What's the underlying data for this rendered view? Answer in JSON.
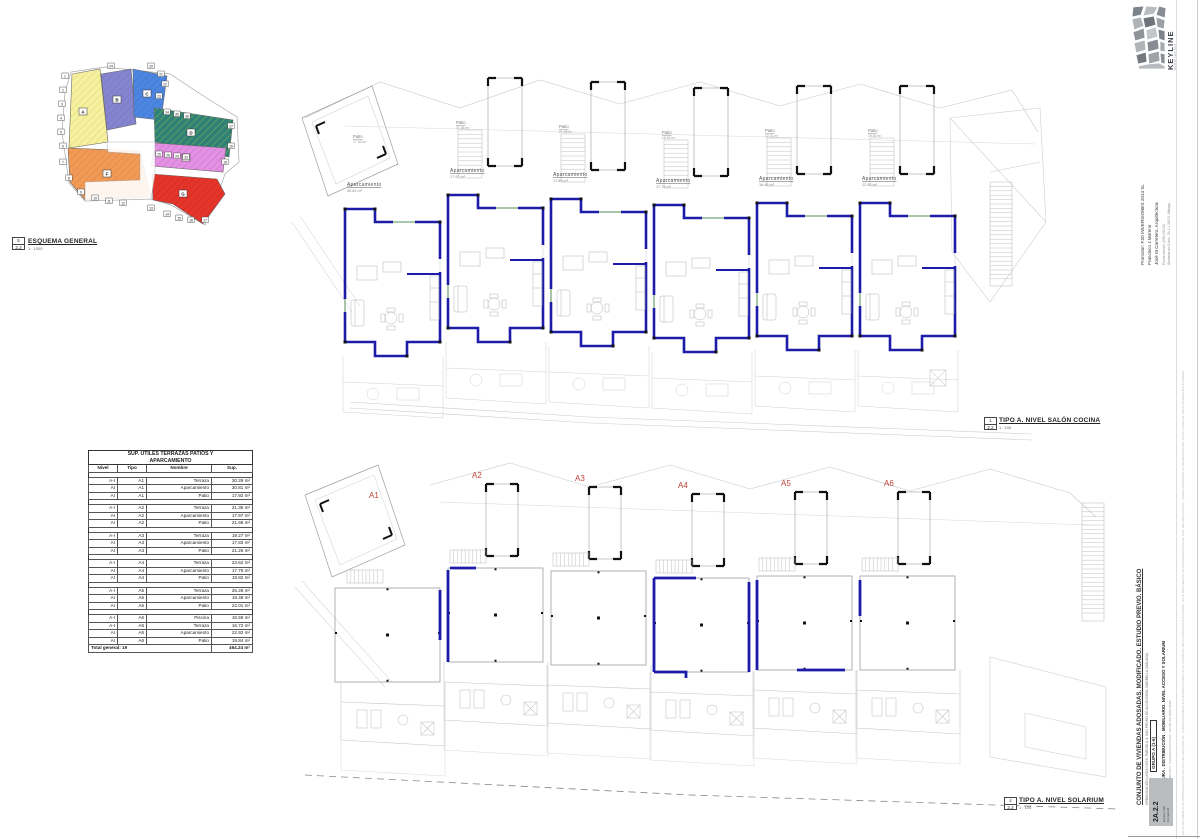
{
  "accent": {
    "wall_blue": "#1c1ca8",
    "unit_red": "#c04038"
  },
  "esquema": {
    "tag_num": "5",
    "tag_sheet": "2.2",
    "title": "ESQUEMA GENERAL",
    "scale": "1 : 1000",
    "zones": [
      {
        "id": "yellow",
        "label": "A",
        "color": "#f5f1a0",
        "hatch": "#d8ca55",
        "points": "17,12 45,7 53,80 14,86",
        "lx": 28,
        "ly": 50
      },
      {
        "id": "purple",
        "label": "B",
        "color": "#8585cf",
        "hatch": "#6a6ab8",
        "points": "46,12 76,7 81,62 52,68",
        "lx": 62,
        "ly": 38
      },
      {
        "id": "blue",
        "label": "C",
        "color": "#4d86e0",
        "hatch": "#3568c4",
        "points": "78,7 112,14 106,58 79,55",
        "lx": 92,
        "ly": 32
      },
      {
        "id": "teal",
        "label": "D",
        "color": "#2f8077",
        "hatch": "#9ccf3f",
        "points": "99,46 178,58 174,95 100,80",
        "lx": 136,
        "ly": 71
      },
      {
        "id": "pink",
        "label": "E",
        "color": "#e392e3",
        "hatch": "#c05fc0",
        "points": "100,81 171,86 168,110 96,104",
        "lx": 131,
        "ly": 96
      },
      {
        "id": "orange",
        "label": "F",
        "color": "#f09a58",
        "hatch": "#d97a30",
        "points": "13,86 85,89 96,135 30,138 15,120",
        "lx": 52,
        "ly": 112
      },
      {
        "id": "red",
        "label": "G",
        "color": "#e5352b",
        "hatch": "#c01f18",
        "points": "97,112 162,117 170,132 148,162 118,142 98,138",
        "lx": 128,
        "ly": 132
      }
    ],
    "markers": [
      {
        "t": "1",
        "x": 10,
        "y": 14
      },
      {
        "t": "2",
        "x": 8,
        "y": 28
      },
      {
        "t": "3",
        "x": 7,
        "y": 42
      },
      {
        "t": "4",
        "x": 6,
        "y": 56
      },
      {
        "t": "5",
        "x": 6,
        "y": 70
      },
      {
        "t": "6",
        "x": 8,
        "y": 84
      },
      {
        "t": "7",
        "x": 8,
        "y": 100
      },
      {
        "t": "8",
        "x": 14,
        "y": 116
      },
      {
        "t": "9",
        "x": 26,
        "y": 130
      },
      {
        "t": "10",
        "x": 40,
        "y": 136
      },
      {
        "t": "11",
        "x": 54,
        "y": 139
      },
      {
        "t": "12",
        "x": 68,
        "y": 141
      },
      {
        "t": "13",
        "x": 96,
        "y": 146
      },
      {
        "t": "14",
        "x": 112,
        "y": 152
      },
      {
        "t": "15",
        "x": 124,
        "y": 156
      },
      {
        "t": "16",
        "x": 136,
        "y": 158
      },
      {
        "t": "17",
        "x": 150,
        "y": 158
      },
      {
        "t": "18",
        "x": 170,
        "y": 100
      },
      {
        "t": "19",
        "x": 176,
        "y": 84
      },
      {
        "t": "20",
        "x": 96,
        "y": 4
      },
      {
        "t": "21",
        "x": 106,
        "y": 12
      },
      {
        "t": "22",
        "x": 110,
        "y": 22
      },
      {
        "t": "23",
        "x": 104,
        "y": 34
      },
      {
        "t": "24",
        "x": 56,
        "y": 4
      },
      {
        "t": "25",
        "x": 104,
        "y": 92
      },
      {
        "t": "26",
        "x": 113,
        "y": 93
      },
      {
        "t": "27",
        "x": 176,
        "y": 64
      },
      {
        "t": "28",
        "x": 122,
        "y": 94
      },
      {
        "t": "33",
        "x": 131,
        "y": 95
      },
      {
        "t": "34",
        "x": 112,
        "y": 50
      },
      {
        "t": "35",
        "x": 122,
        "y": 52
      },
      {
        "t": "36",
        "x": 132,
        "y": 54
      }
    ]
  },
  "table": {
    "title_line1": "SUP. ÚTILES TERRAZAS PATIOS Y",
    "title_line2": "APARCAMIENTO",
    "columns": [
      "Nivel",
      "Tipo",
      "Nombre",
      "Sup."
    ],
    "groups": [
      [
        [
          "A-I",
          "A1",
          "Terraza",
          "30.29 m²"
        ],
        [
          "AI",
          "A1",
          "Aparcamiento",
          "30.81 m²"
        ],
        [
          "AI",
          "A1",
          "Patio",
          "17.92 m²"
        ]
      ],
      [
        [
          "A-I",
          "A2",
          "Terraza",
          "21.35 m²"
        ],
        [
          "AI",
          "A2",
          "Aparcamiento",
          "17.97 m²"
        ],
        [
          "AI",
          "A2",
          "Patio",
          "21.68 m²"
        ]
      ],
      [
        [
          "A-I",
          "A3",
          "Terraza",
          "19.27 m²"
        ],
        [
          "AI",
          "A3",
          "Aparcamiento",
          "17.83 m²"
        ],
        [
          "AI",
          "A3",
          "Patio",
          "21.26 m²"
        ]
      ],
      [
        [
          "A-I",
          "A4",
          "Terraza",
          "23.62 m²"
        ],
        [
          "AI",
          "A4",
          "Aparcamiento",
          "17.79 m²"
        ],
        [
          "AI",
          "A4",
          "Patio",
          "18.82 m²"
        ]
      ],
      [
        [
          "A-I",
          "A5",
          "Terraza",
          "25.28 m²"
        ],
        [
          "AI",
          "A5",
          "Aparcamiento",
          "18.48 m²"
        ],
        [
          "AI",
          "A5",
          "Patio",
          "22.01 m²"
        ]
      ],
      [
        [
          "A-I",
          "A6",
          "Piscina",
          "16.59 m²"
        ],
        [
          "A-I",
          "A6",
          "Terraza",
          "16.72 m²"
        ],
        [
          "AI",
          "A6",
          "Aparcamiento",
          "22.92 m²"
        ],
        [
          "AI",
          "A6",
          "Patio",
          "19.84 m²"
        ]
      ]
    ],
    "total_label": "Total general: 19",
    "total_value": "464.24 m²"
  },
  "top_plan": {
    "tag_num": "1",
    "tag_sheet": "2.2",
    "title": "TIPO A. NIVEL SALÓN COCINA",
    "scale": "1 : 100",
    "units": [
      {
        "name": "A1",
        "aparcamiento": "Aparcamiento",
        "apar_area": "30.81 m²",
        "patio": "Patio",
        "patio_area": "17.92 m²"
      },
      {
        "name": "A2",
        "aparcamiento": "Aparcamiento",
        "apar_area": "17.97 m²",
        "patio": "Patio",
        "patio_area": "21.68 m²"
      },
      {
        "name": "A3",
        "aparcamiento": "Aparcamiento",
        "apar_area": "17.83 m²",
        "patio": "Patio",
        "patio_area": "21.26 m²"
      },
      {
        "name": "A4",
        "aparcamiento": "Aparcamiento",
        "apar_area": "17.79 m²",
        "patio": "Patio",
        "patio_area": "18.82 m²"
      },
      {
        "name": "A5",
        "aparcamiento": "Aparcamiento",
        "apar_area": "18.48 m²",
        "patio": "Patio",
        "patio_area": "22.01 m²"
      },
      {
        "name": "A6",
        "aparcamiento": "Aparcamiento",
        "apar_area": "22.92 m²",
        "patio": "Patio",
        "patio_area": "19.84 m²"
      }
    ]
  },
  "bottom_plan": {
    "tag_num": "4",
    "tag_sheet": "2.2",
    "title": "TIPO A. NIVEL SOLARIUM",
    "scale": "1 : 100",
    "units": [
      {
        "label": "A1"
      },
      {
        "label": "A2"
      },
      {
        "label": "A3"
      },
      {
        "label": "A4"
      },
      {
        "label": "A5"
      },
      {
        "label": "A6"
      }
    ]
  },
  "titleblock": {
    "logo": "KEYLINE",
    "logo_sub": "ARQUITECTOS",
    "promoter_lines": [
      "Promotor: FJD INVERSIONES 2014 SL",
      "Francisco J Moreno",
      "José M Carretero. Arquitectura"
    ],
    "small_lines": [
      "Fecha edición (29/10/2015)",
      "Alameda de Colón, 29 1-1 29001 Málaga"
    ],
    "project_title": "CONJUNTO DE VIVIENDAS ADOSADAS. MODIFICADO. ESTUDIO PREVIO. BÁSICO",
    "project_sub": "URBANIZACIÓN LINDA VISTA. PARCELA 4. SAN PEDRO DE ALCÁNTARA. MARBELLA (MÁLAGA)",
    "group_box": "GRUPO A (1-6)",
    "drawing_title": "ARQUITECTURA . DISTRIBUCIÓN . MOBILIARIO. NIVEL ACCESO Y SOLARIUM",
    "tiny_note": "E 1:100 . COTAS EN METROS . SUPERFICIES ÚTILES . NO VÁLIDO PARA OBRA",
    "sheet_code": "2A.2.2",
    "sheet_sub1": "Escala 1:100",
    "sheet_sub2": "Formato A1",
    "fine_print": "ESTE DOCUMENTO ES PROPIEDAD INTELECTUAL DEL ARQUITECTO . QUEDA PROHIBIDA SU REPRODUCCIÓN TOTAL O PARCIAL SIN AUTORIZACIÓN EXPRESA . ESTE DOCUMENTO ES PROPIEDAD INTELECTUAL DEL ARQUITECTO . QUEDA PROHIBIDA SU REPRODUCCIÓN TOTAL O PARCIAL SIN AUTORIZACIÓN EXPRESA"
  }
}
